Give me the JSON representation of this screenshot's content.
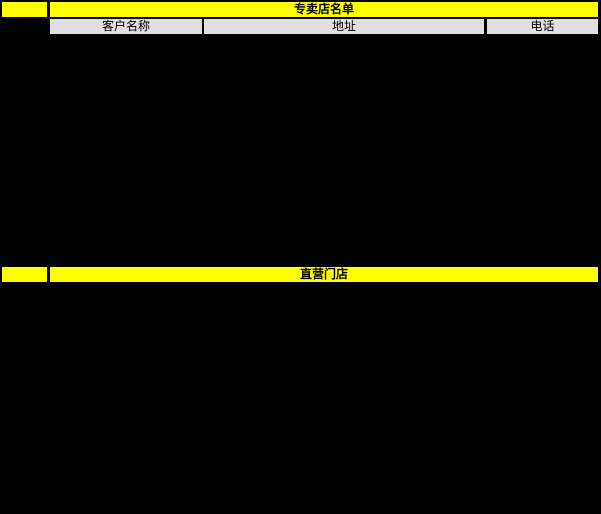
{
  "sheet": {
    "section1": {
      "title": "专卖店名单"
    },
    "columns": [
      {
        "label": "客户名称"
      },
      {
        "label": "地址"
      },
      {
        "label": "电话"
      }
    ],
    "section2": {
      "title": "直营门店"
    }
  },
  "colors": {
    "section_fill": "#FFFF00",
    "header_fill": "#E0E0E0",
    "background": "#000000",
    "text": "#000000"
  }
}
